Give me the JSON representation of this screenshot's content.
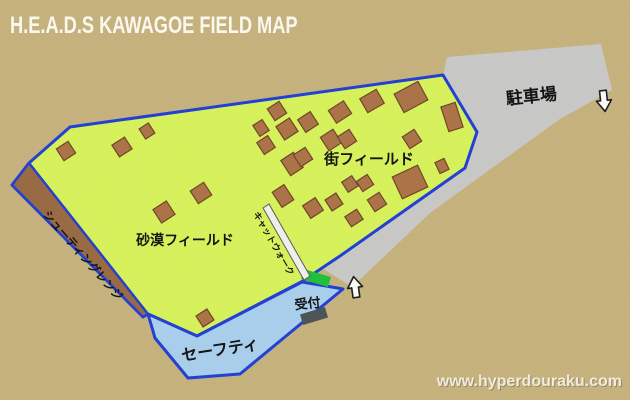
{
  "title": "H.E.A.D.S KAWAGOE FIELD MAP",
  "watermark": "www.hyperdouraku.com",
  "areas": {
    "parking": {
      "label": "駐車場"
    },
    "street_field": {
      "label": "街フィールド"
    },
    "desert_field": {
      "label": "砂漠フィールド"
    },
    "shooting_range": {
      "label": "シューティングレンジ"
    },
    "catwalk": {
      "label": "キャットウォーク"
    },
    "safety": {
      "label": "セーフティ"
    },
    "reception": {
      "label": "受付"
    }
  },
  "icons": {
    "parking_entrance": "arrow-down",
    "field_entrance": "arrow-up"
  },
  "colors": {
    "background_tan": "#c8b47e",
    "field_green": "#daf65c",
    "border_blue": "#1e3ed8",
    "parking_gray": "#cbcbcb",
    "safety_blue": "#aad2f1",
    "range_brown": "#9a6a42",
    "building_brown": "#ad7347",
    "building_border": "#6f4426",
    "gate_green": "#1dc23c",
    "reception_gray": "#4a5358",
    "catwalk_white": "#f3f3f0",
    "title_white": "#faf7ef"
  },
  "map": {
    "buildings": [
      [
        277,
        111,
        14,
        14,
        -33
      ],
      [
        287,
        129,
        16,
        16,
        -33
      ],
      [
        308,
        122,
        15,
        15,
        -33
      ],
      [
        340,
        112,
        18,
        15,
        -33
      ],
      [
        372,
        101,
        19,
        16,
        -30
      ],
      [
        411,
        97,
        27,
        21,
        -28
      ],
      [
        452,
        117,
        15,
        26,
        -18
      ],
      [
        261,
        128,
        11,
        13,
        -33
      ],
      [
        266,
        145,
        13,
        14,
        -33
      ],
      [
        331,
        140,
        15,
        16,
        -33
      ],
      [
        347,
        139,
        14,
        14,
        -33
      ],
      [
        412,
        139,
        14,
        14,
        -33
      ],
      [
        292,
        164,
        15,
        18,
        -33
      ],
      [
        303,
        157,
        14,
        14,
        -33
      ],
      [
        442,
        166,
        10,
        12,
        -25
      ],
      [
        410,
        182,
        28,
        24,
        -25
      ],
      [
        350,
        184,
        12,
        12,
        -33
      ],
      [
        365,
        183,
        13,
        12,
        -33
      ],
      [
        283,
        196,
        14,
        18,
        -33
      ],
      [
        313,
        208,
        15,
        15,
        -33
      ],
      [
        334,
        202,
        13,
        13,
        -33
      ],
      [
        377,
        202,
        14,
        14,
        -33
      ],
      [
        354,
        218,
        14,
        12,
        -33
      ],
      [
        66,
        151,
        14,
        14,
        -33
      ],
      [
        122,
        147,
        15,
        14,
        -33
      ],
      [
        147,
        131,
        11,
        12,
        -33
      ],
      [
        164,
        212,
        16,
        16,
        -33
      ],
      [
        201,
        193,
        16,
        15,
        -33
      ],
      [
        205,
        318,
        13,
        13,
        -33
      ]
    ]
  }
}
